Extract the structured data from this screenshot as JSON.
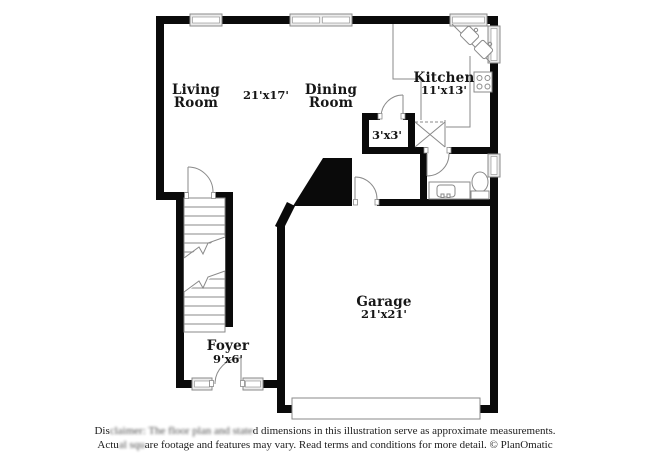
{
  "rooms": {
    "living": {
      "line1": "Living",
      "line2": "Room"
    },
    "living_dims": "21'x17'",
    "dining": {
      "line1": "Dining",
      "line2": "Room"
    },
    "kitchen": {
      "name": "Kitchen",
      "dims": "11'x13'"
    },
    "closet_dims": "3'x3'",
    "garage": {
      "name": "Garage",
      "dims": "21'x21'"
    },
    "foyer": {
      "name": "Foyer",
      "dims": "9'x6'"
    }
  },
  "disclaimer": {
    "line1": {
      "a": "Dis",
      "b": "claimer: The floor plan and state",
      "c": "d dimensions in this illustration serve as approximate measurements."
    },
    "line2": {
      "a": "Actu",
      "b": "al squ",
      "c": "are footage and features may vary. Read terms and conditions for more detail. © PlanOmatic"
    }
  },
  "colors": {
    "wall": "#0a0a0a",
    "fixture_line": "#8a8a8a",
    "window_fill": "#ececec",
    "background": "#ffffff",
    "text": "#161616"
  }
}
